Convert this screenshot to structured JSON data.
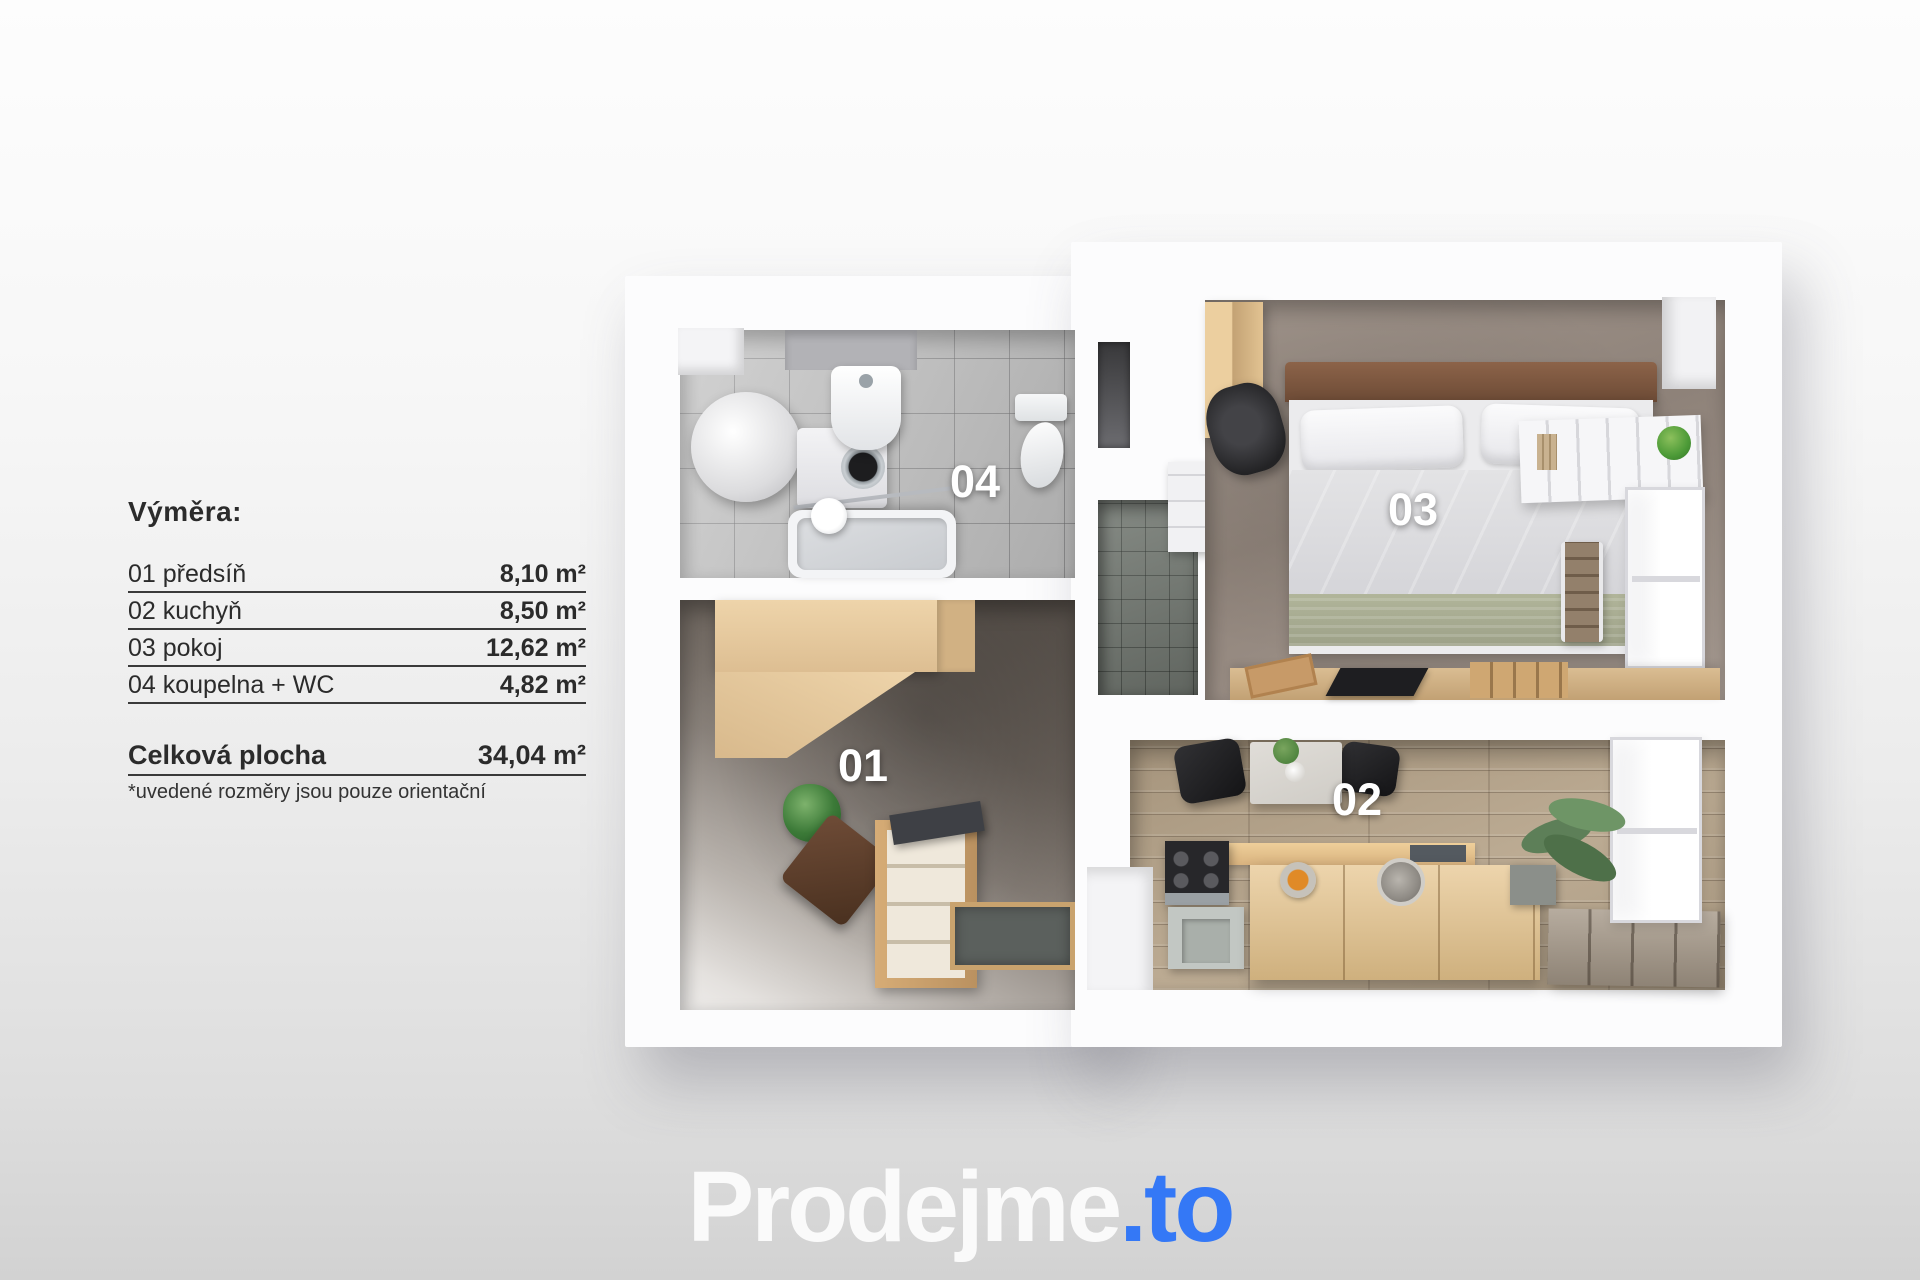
{
  "legend": {
    "title": "Výměra:",
    "rows": [
      {
        "name": "01 předsíň",
        "area": "8,10 m²"
      },
      {
        "name": "02 kuchyň",
        "area": "8,50 m²"
      },
      {
        "name": "03 pokoj",
        "area": "12,62 m²"
      },
      {
        "name": "04 koupelna + WC",
        "area": "4,82 m²"
      }
    ],
    "total_label": "Celková plocha",
    "total_area": "34,04 m²",
    "note": "*uvedené rozměry jsou pouze orientační"
  },
  "plan": {
    "room_labels": [
      {
        "text": "01"
      },
      {
        "text": "02"
      },
      {
        "text": "03"
      },
      {
        "text": "04"
      }
    ]
  },
  "logo": {
    "brand": "Prodejme",
    "suffix": ".to"
  },
  "colors": {
    "logo_brand_white": "#fafafa",
    "logo_accent_blue": "#3478f6",
    "legend_text": "#2b2b2b",
    "room_label_white": "#ffffff"
  }
}
